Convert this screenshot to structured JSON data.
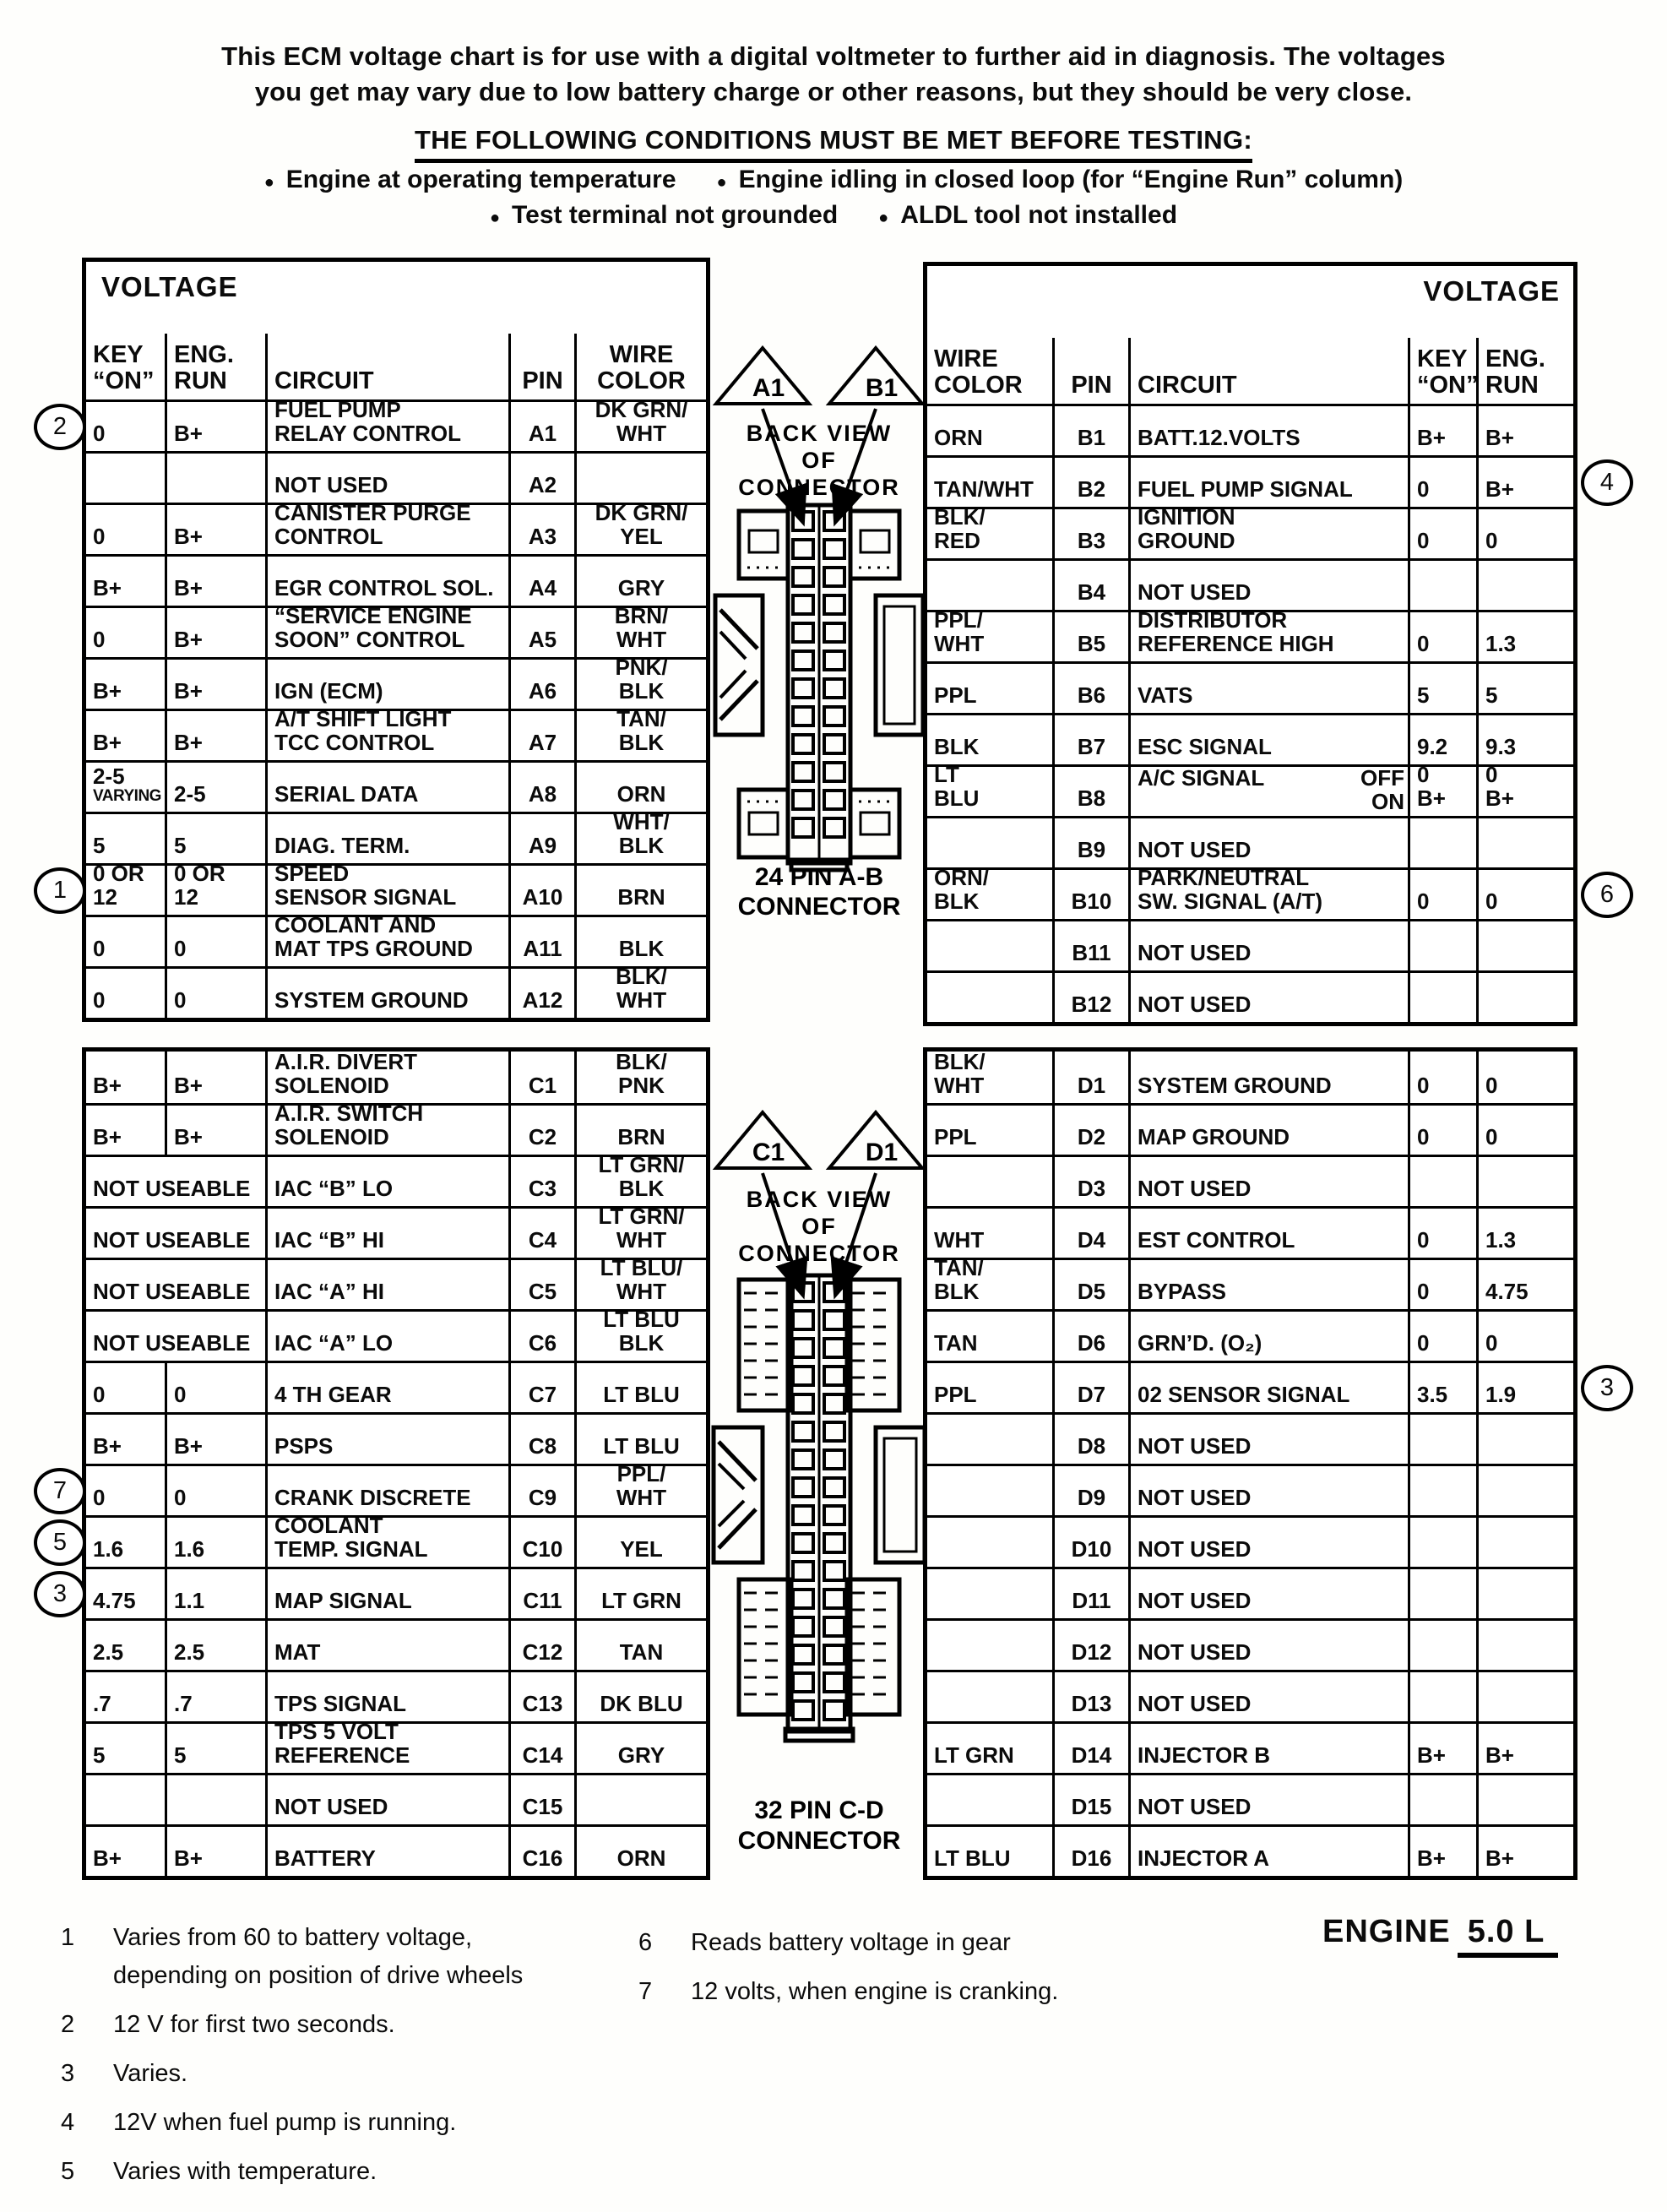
{
  "header": {
    "intro": "This ECM voltage chart is for use with a digital voltmeter to further aid in diagnosis.  The voltages\nyou get may vary due to low battery charge or other reasons, but they should be very close.",
    "conditions_title": "THE FOLLOWING CONDITIONS MUST BE MET BEFORE TESTING:",
    "bullets_line1": [
      "Engine at operating temperature",
      "Engine idling in closed loop (for “Engine Run” column)"
    ],
    "bullets_line2": [
      "Test terminal not grounded",
      "ALDL tool not installed"
    ]
  },
  "left_table": {
    "voltage_label": "VOLTAGE",
    "headers": {
      "key": "KEY\n“ON”",
      "eng": "ENG.\nRUN",
      "circuit": "CIRCUIT",
      "pin": "PIN",
      "wire": "WIRE\nCOLOR"
    },
    "section_a": [
      {
        "key": "0",
        "eng": "B+",
        "circuit": "FUEL PUMP\nRELAY CONTROL",
        "pin": "A1",
        "wire": "DK GRN/\nWHT"
      },
      {
        "key": "",
        "eng": "",
        "circuit": "NOT USED",
        "pin": "A2",
        "wire": ""
      },
      {
        "key": "0",
        "eng": "B+",
        "circuit": "CANISTER PURGE\nCONTROL",
        "pin": "A3",
        "wire": "DK GRN/\nYEL"
      },
      {
        "key": "B+",
        "eng": "B+",
        "circuit": "EGR CONTROL SOL.",
        "pin": "A4",
        "wire": "GRY"
      },
      {
        "key": "0",
        "eng": "B+",
        "circuit": "“SERVICE ENGINE\nSOON” CONTROL",
        "pin": "A5",
        "wire": "BRN/\nWHT"
      },
      {
        "key": "B+",
        "eng": "B+",
        "circuit": "IGN (ECM)",
        "pin": "A6",
        "wire": "PNK/\nBLK"
      },
      {
        "key": "B+",
        "eng": "B+",
        "circuit": "A/T SHIFT LIGHT\nTCC CONTROL",
        "pin": "A7",
        "wire": "TAN/\nBLK"
      },
      {
        "key": "2-5",
        "key_sub": "VARYING",
        "eng": "2-5",
        "circuit": "SERIAL DATA",
        "pin": "A8",
        "wire": "ORN"
      },
      {
        "key": "5",
        "eng": "5",
        "circuit": "DIAG. TERM.",
        "pin": "A9",
        "wire": "WHT/\nBLK"
      },
      {
        "key": "0 OR\n12",
        "eng": "0 OR\n12",
        "circuit": "SPEED\nSENSOR SIGNAL",
        "pin": "A10",
        "wire": "BRN"
      },
      {
        "key": "0",
        "eng": "0",
        "circuit": "COOLANT AND\nMAT TPS GROUND",
        "pin": "A11",
        "wire": "BLK"
      },
      {
        "key": "0",
        "eng": "0",
        "circuit": "SYSTEM GROUND",
        "pin": "A12",
        "wire": "BLK/\nWHT"
      }
    ],
    "section_c": [
      {
        "key": "B+",
        "eng": "B+",
        "circuit": "A.I.R. DIVERT\nSOLENOID",
        "pin": "C1",
        "wire": "BLK/\nPNK"
      },
      {
        "key": "B+",
        "eng": "B+",
        "circuit": "A.I.R. SWITCH\nSOLENOID",
        "pin": "C2",
        "wire": "BRN"
      },
      {
        "span": "NOT USEABLE",
        "circuit": "IAC “B” LO",
        "pin": "C3",
        "wire": "LT GRN/\nBLK"
      },
      {
        "span": "NOT USEABLE",
        "circuit": "IAC “B” HI",
        "pin": "C4",
        "wire": "LT GRN/\nWHT"
      },
      {
        "span": "NOT USEABLE",
        "circuit": "IAC “A” HI",
        "pin": "C5",
        "wire": "LT BLU/\nWHT"
      },
      {
        "span": "NOT USEABLE",
        "circuit": "IAC “A” LO",
        "pin": "C6",
        "wire": "LT BLU\nBLK"
      },
      {
        "key": "0",
        "eng": "0",
        "circuit": "4 TH GEAR",
        "pin": "C7",
        "wire": "LT BLU"
      },
      {
        "key": "B+",
        "eng": "B+",
        "circuit": "PSPS",
        "pin": "C8",
        "wire": "LT BLU"
      },
      {
        "key": "0",
        "eng": "0",
        "circuit": "CRANK DISCRETE",
        "pin": "C9",
        "wire": "PPL/\nWHT"
      },
      {
        "key": "1.6",
        "eng": "1.6",
        "circuit": "COOLANT\nTEMP. SIGNAL",
        "pin": "C10",
        "wire": "YEL"
      },
      {
        "key": "4.75",
        "eng": "1.1",
        "circuit": "MAP SIGNAL",
        "pin": "C11",
        "wire": "LT GRN"
      },
      {
        "key": "2.5",
        "eng": "2.5",
        "circuit": "MAT",
        "pin": "C12",
        "wire": "TAN"
      },
      {
        "key": ".7",
        "eng": ".7",
        "circuit": "TPS SIGNAL",
        "pin": "C13",
        "wire": "DK BLU"
      },
      {
        "key": "5",
        "eng": "5",
        "circuit": "TPS 5 VOLT\nREFERENCE",
        "pin": "C14",
        "wire": "GRY"
      },
      {
        "key": "",
        "eng": "",
        "circuit": "NOT USED",
        "pin": "C15",
        "wire": ""
      },
      {
        "key": "B+",
        "eng": "B+",
        "circuit": "BATTERY",
        "pin": "C16",
        "wire": "ORN"
      }
    ]
  },
  "right_table": {
    "voltage_label": "VOLTAGE",
    "headers": {
      "wire": "WIRE\nCOLOR",
      "pin": "PIN",
      "circuit": "CIRCUIT",
      "key": "KEY\n“ON”",
      "eng": "ENG.\nRUN"
    },
    "section_b": [
      {
        "wire": "ORN",
        "pin": "B1",
        "circuit": "BATT.12.VOLTS",
        "key": "B+",
        "eng": "B+"
      },
      {
        "wire": "TAN/WHT",
        "pin": "B2",
        "circuit": "FUEL PUMP SIGNAL",
        "key": "0",
        "eng": "B+"
      },
      {
        "wire": "BLK/\nRED",
        "pin": "B3",
        "circuit": "IGNITION\nGROUND",
        "key": "0",
        "eng": "0"
      },
      {
        "wire": "",
        "pin": "B4",
        "circuit": "NOT USED",
        "key": "",
        "eng": ""
      },
      {
        "wire": "PPL/\nWHT",
        "pin": "B5",
        "circuit": "DISTRIBUTOR\nREFERENCE HIGH",
        "key": "0",
        "eng": "1.3"
      },
      {
        "wire": "PPL",
        "pin": "B6",
        "circuit": "VATS",
        "key": "5",
        "eng": "5"
      },
      {
        "wire": "BLK",
        "pin": "B7",
        "circuit": "ESC SIGNAL",
        "key": "9.2",
        "eng": "9.3"
      },
      {
        "wire": "LT\nBLU",
        "pin": "B8",
        "circuit": "A/C SIGNAL",
        "circuit_right": "OFF\nON",
        "key": "0\nB+",
        "eng": "0\nB+"
      },
      {
        "wire": "",
        "pin": "B9",
        "circuit": "NOT USED",
        "key": "",
        "eng": ""
      },
      {
        "wire": "ORN/\nBLK",
        "pin": "B10",
        "circuit": "PARK/NEUTRAL\nSW. SIGNAL (A/T)",
        "key": "0",
        "eng": "0"
      },
      {
        "wire": "",
        "pin": "B11",
        "circuit": "NOT USED",
        "key": "",
        "eng": ""
      },
      {
        "wire": "",
        "pin": "B12",
        "circuit": "NOT USED",
        "key": "",
        "eng": ""
      }
    ],
    "section_d": [
      {
        "wire": "BLK/\nWHT",
        "pin": "D1",
        "circuit": "SYSTEM GROUND",
        "key": "0",
        "eng": "0"
      },
      {
        "wire": "PPL",
        "pin": "D2",
        "circuit": "MAP GROUND",
        "key": "0",
        "eng": "0"
      },
      {
        "wire": "",
        "pin": "D3",
        "circuit": "NOT USED",
        "key": "",
        "eng": ""
      },
      {
        "wire": "WHT",
        "pin": "D4",
        "circuit": "EST CONTROL",
        "key": "0",
        "eng": "1.3"
      },
      {
        "wire": "TAN/\nBLK",
        "pin": "D5",
        "circuit": "BYPASS",
        "key": "0",
        "eng": "4.75"
      },
      {
        "wire": "TAN",
        "pin": "D6",
        "circuit": "GRN’D. (O₂)",
        "key": "0",
        "eng": "0"
      },
      {
        "wire": "PPL",
        "pin": "D7",
        "circuit": "02 SENSOR SIGNAL",
        "key": "3.5",
        "eng": "1.9"
      },
      {
        "wire": "",
        "pin": "D8",
        "circuit": "NOT USED",
        "key": "",
        "eng": ""
      },
      {
        "wire": "",
        "pin": "D9",
        "circuit": "NOT USED",
        "key": "",
        "eng": ""
      },
      {
        "wire": "",
        "pin": "D10",
        "circuit": "NOT USED",
        "key": "",
        "eng": ""
      },
      {
        "wire": "",
        "pin": "D11",
        "circuit": "NOT USED",
        "key": "",
        "eng": ""
      },
      {
        "wire": "",
        "pin": "D12",
        "circuit": "NOT USED",
        "key": "",
        "eng": ""
      },
      {
        "wire": "",
        "pin": "D13",
        "circuit": "NOT USED",
        "key": "",
        "eng": ""
      },
      {
        "wire": "LT GRN",
        "pin": "D14",
        "circuit": "INJECTOR B",
        "key": "B+",
        "eng": "B+"
      },
      {
        "wire": "",
        "pin": "D15",
        "circuit": "NOT USED",
        "key": "",
        "eng": ""
      },
      {
        "wire": "LT BLU",
        "pin": "D16",
        "circuit": "INJECTOR A",
        "key": "B+",
        "eng": "B+"
      }
    ]
  },
  "connectors": {
    "ab": {
      "tri_left": "A1",
      "tri_right": "B1",
      "back_view": [
        "BACK VIEW",
        "OF",
        "CONNECTOR"
      ],
      "pin_rows": 12,
      "label_line1": "24 PIN  A-B",
      "label_line2": "CONNECTOR"
    },
    "cd": {
      "tri_left": "C1",
      "tri_right": "D1",
      "back_view": [
        "BACK VIEW",
        "OF",
        "CONNECTOR"
      ],
      "pin_rows": 16,
      "label_line1": "32  PIN C-D",
      "label_line2": "CONNECTOR"
    }
  },
  "callouts": [
    {
      "label": "2",
      "pin": "A1"
    },
    {
      "label": "1",
      "pin": "A10"
    },
    {
      "label": "7",
      "pin": "C9"
    },
    {
      "label": "5",
      "pin": "C10"
    },
    {
      "label": "3",
      "pin": "C11"
    },
    {
      "label": "4",
      "pin": "B2"
    },
    {
      "label": "6",
      "pin": "B10"
    },
    {
      "label": "3",
      "pin": "D7"
    }
  ],
  "footnotes_left": [
    {
      "num": "1",
      "text": "Varies from  60 to battery voltage,\ndepending on position of drive wheels"
    },
    {
      "num": "2",
      "text": "12 V for first two seconds."
    },
    {
      "num": "3",
      "text": "Varies."
    },
    {
      "num": "4",
      "text": "12V when fuel pump is running."
    },
    {
      "num": "5",
      "text": "Varies with temperature."
    }
  ],
  "footnotes_right": [
    {
      "num": "6",
      "text": "Reads battery voltage in gear"
    },
    {
      "num": "7",
      "text": "12 volts, when engine is cranking."
    }
  ],
  "engine": {
    "label": "ENGINE",
    "value": "5.0 L"
  }
}
